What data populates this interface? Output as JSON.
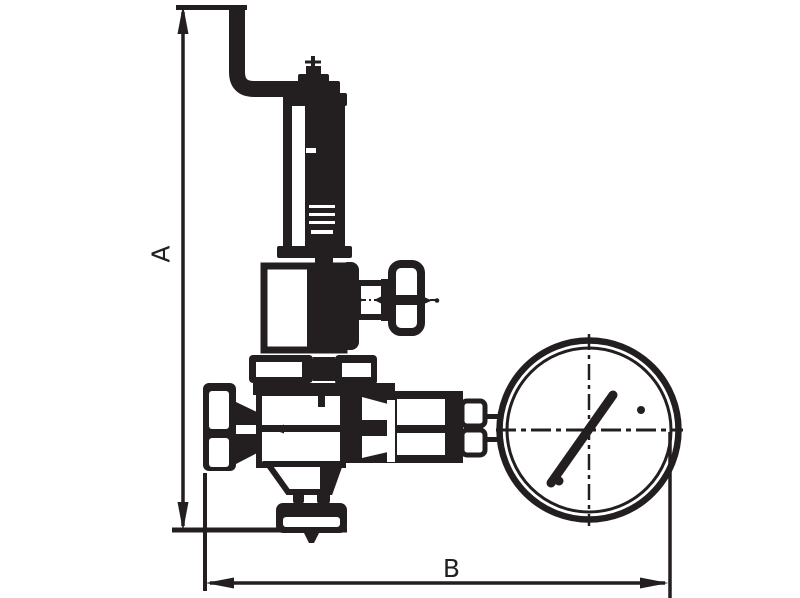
{
  "figure": {
    "type": "technical-outline-drawing",
    "subject": "safety relief valve with spring bonnet, side handwheel tap and pressure gauge",
    "ink_color": "#231f20",
    "background_color": "#ffffff",
    "dimension_labels": {
      "vertical": "A",
      "horizontal": "B"
    },
    "components": [
      "bent-inlet-pipe",
      "adjusting-cap",
      "spring-bonnet",
      "side-tap-handwheel",
      "upper-body",
      "bonnet-flange",
      "inlet-flange",
      "valve-body",
      "outlet-union",
      "gauge-stem",
      "pressure-gauge",
      "gauge-needle",
      "bottom-outlet-flange"
    ]
  }
}
